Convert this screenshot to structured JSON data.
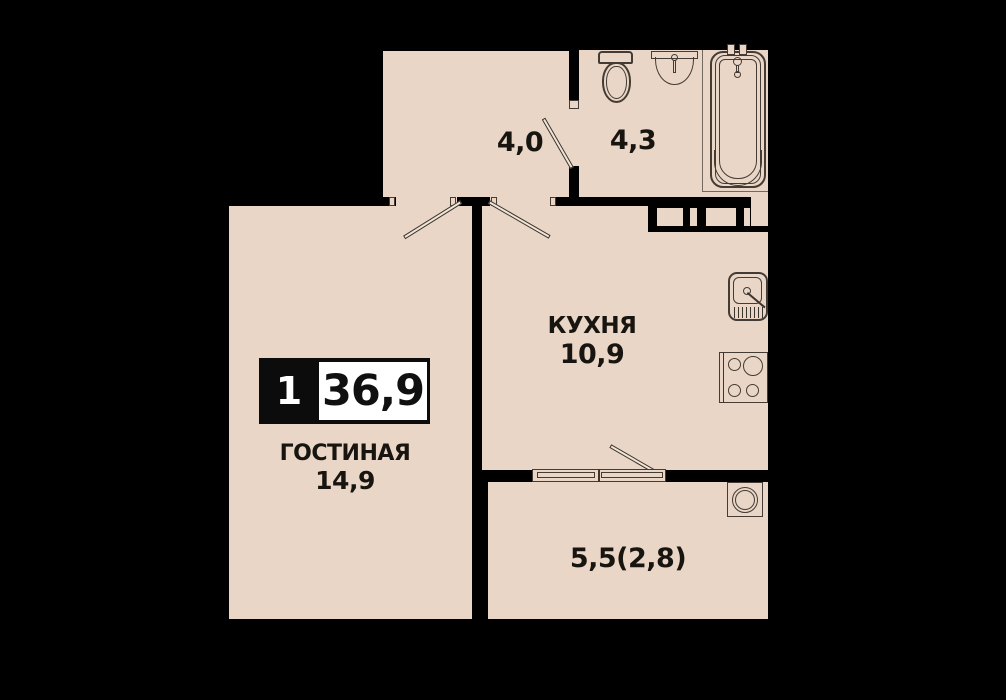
{
  "plan": {
    "badge": {
      "rooms_count": "1",
      "total_area": "36,9"
    },
    "rooms": {
      "hallway": {
        "area": "4,0"
      },
      "bathroom": {
        "area": "4,3"
      },
      "kitchen": {
        "name": "КУХНЯ",
        "area": "10,9"
      },
      "living": {
        "name": "ГОСТИНАЯ",
        "area": "14,9"
      },
      "balcony": {
        "area": "5,5(2,8)"
      }
    },
    "fixtures": {
      "bathroom": [
        "toilet-icon",
        "washbasin-icon",
        "bathtub-icon"
      ],
      "kitchen": [
        "kitchen-sink-icon",
        "stove-icon"
      ],
      "balcony": [
        "washing-machine-icon"
      ]
    },
    "colors": {
      "background": "#000000",
      "wall": "#000000",
      "floor": "#e9d6c6",
      "fixture_line": "#443c34",
      "badge_bg": "#0c0c0c",
      "badge_value_bg": "#ffffff",
      "text": "#181511"
    }
  }
}
